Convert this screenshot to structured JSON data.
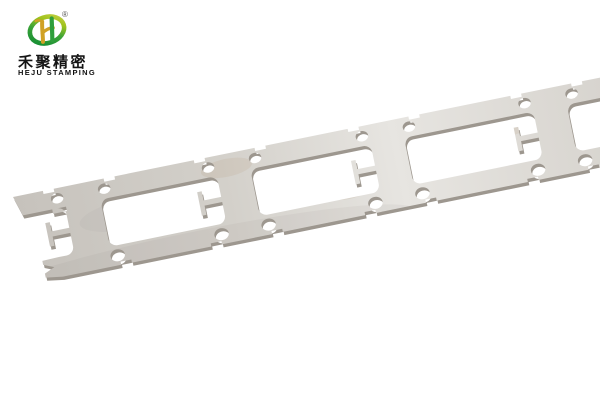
{
  "page": {
    "background_color": "#ffffff",
    "type": "product-photo"
  },
  "brand": {
    "name_cn": "禾聚精密",
    "name_en": "HEJU STAMPING",
    "registered_mark": "®",
    "colors": {
      "ring_green_dark": "#0e8a33",
      "ring_green": "#3ba338",
      "ring_yellow_green": "#9fc31c",
      "ring_yellow": "#c9d14a",
      "h_gold": "#d0a125",
      "h_green": "#2f9e3c",
      "text_color": "#141414"
    }
  },
  "photo": {
    "subject": "stamped metal carrier strip with rectangular windows, pilot holes and T-shaped tabs, laid diagonally on white background",
    "background_color": "#ffffff",
    "strip": {
      "angle_deg": -11.5,
      "origin_x": 13,
      "origin_y": 197,
      "length": 700,
      "height": 88,
      "rail_height": 20,
      "window_top": 20,
      "window_bottom": 68,
      "corner_radius": 8,
      "bar_centers": [
        67,
        221,
        378,
        544,
        715
      ],
      "bar_half_widths": [
        18,
        17,
        17,
        17,
        17
      ],
      "hole_offset": 24,
      "top_hole_rx": 6.3,
      "top_hole_ry": 5.2,
      "bottom_hole_rx": 7.3,
      "bottom_hole_ry": 6,
      "notch_offset": 31,
      "notch_half_width": 5.5,
      "notch_depth": 3.2,
      "tab": {
        "stem_len": 18,
        "stem_half": 2.6,
        "head_w": 4.6,
        "head_half": 12
      },
      "colors": {
        "face_stops": [
          "#c6c2bc",
          "#d3d0ca",
          "#e7e5e1",
          "#dbd8d3",
          "#d0cdc7"
        ],
        "edge": "#9d978f",
        "stain": "#b08d62",
        "shade": "#7d776f"
      }
    }
  }
}
